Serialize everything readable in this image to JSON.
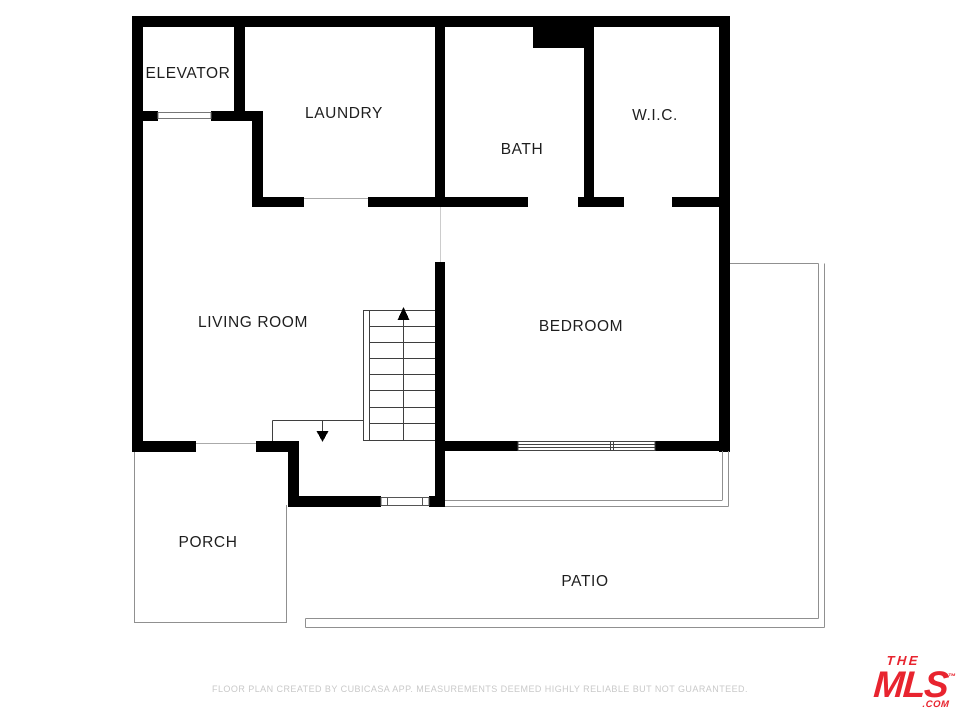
{
  "rooms": {
    "elevator": "ELEVATOR",
    "laundry": "LAUNDRY",
    "bath": "BATH",
    "wic": "W.I.C.",
    "living_room": "LIVING ROOM",
    "bedroom": "BEDROOM",
    "porch": "PORCH",
    "patio": "PATIO"
  },
  "footer": {
    "disclaimer": "FLOOR PLAN CREATED BY CUBICASA APP. MEASUREMENTS DEEMED HIGHLY RELIABLE BUT NOT GUARANTEED."
  },
  "logo": {
    "the": "THE",
    "mls": "MLS",
    "tm": "™",
    "com": ".COM",
    "color": "#e8242f"
  },
  "colors": {
    "wall": "#000000",
    "stair_line": "#3f3f3f",
    "outline": "#909090",
    "label_text": "#1e1e1e",
    "disclaimer_text": "#c9c9c9"
  }
}
